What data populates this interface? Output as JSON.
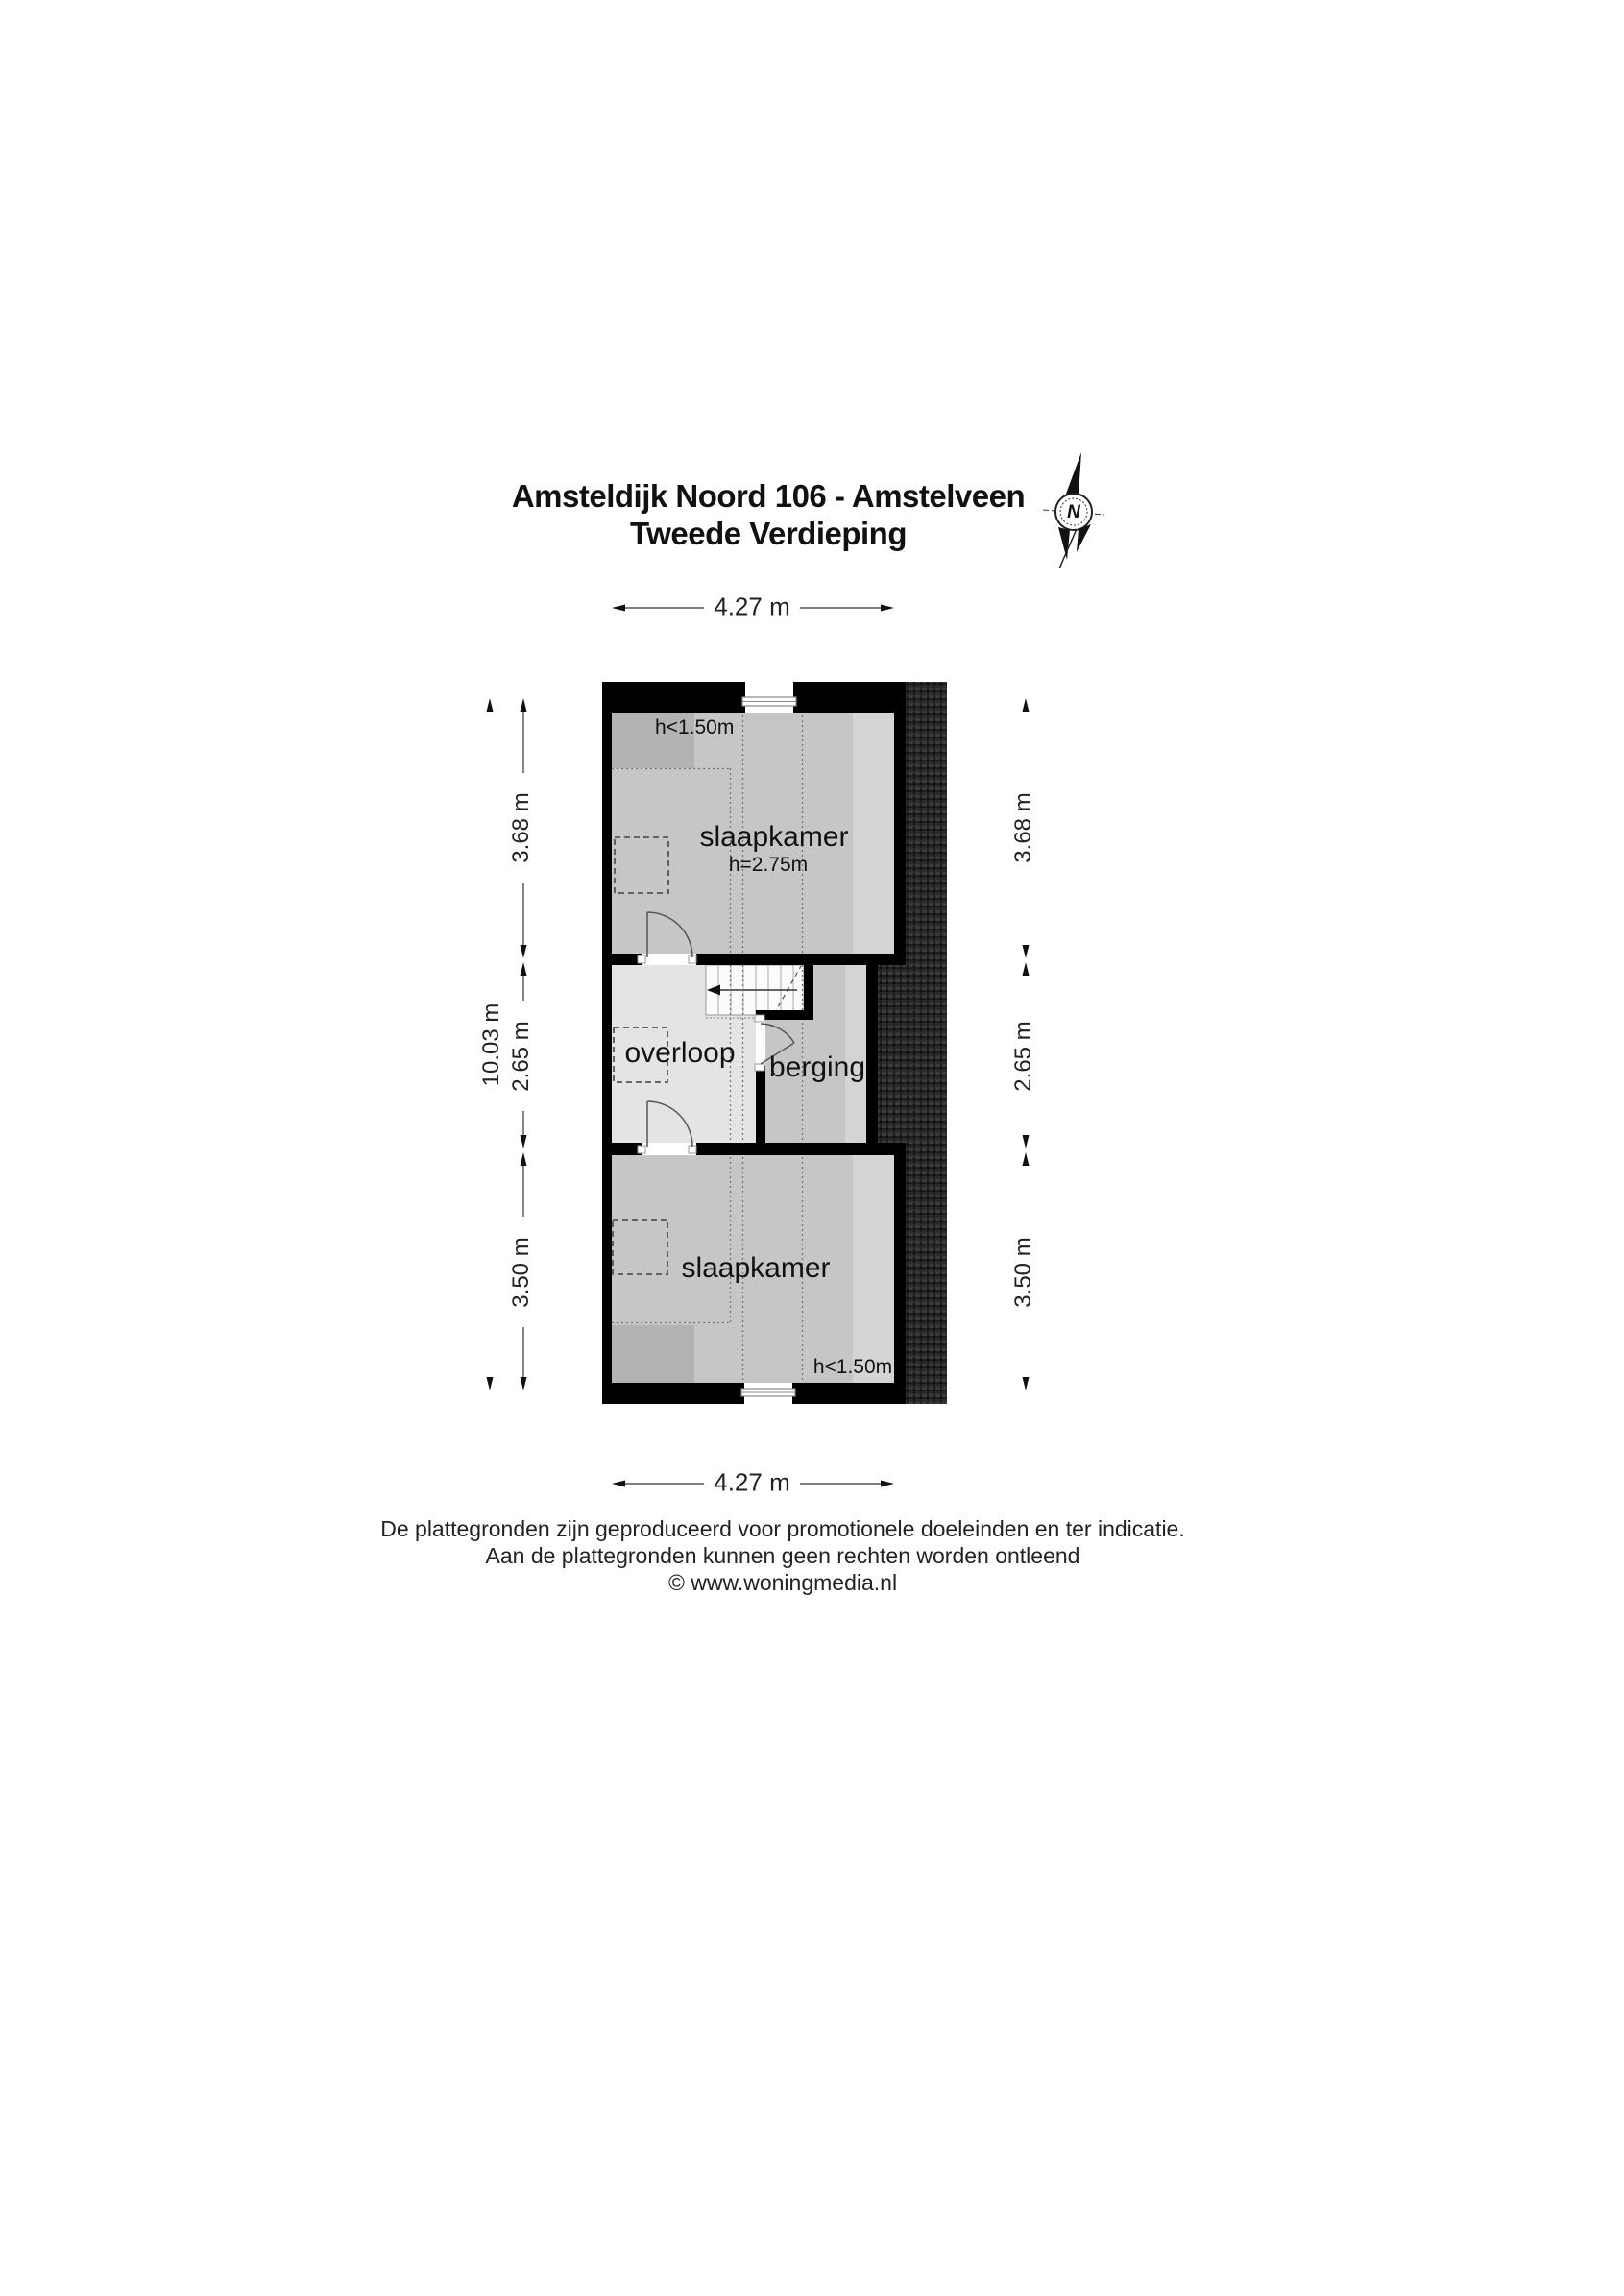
{
  "title": {
    "line1": "Amsteldijk Noord 106 - Amstelveen",
    "line2": "Tweede Verdieping"
  },
  "compass": {
    "label": "N"
  },
  "dimensions": {
    "top": "4.27 m",
    "bottom": "4.27 m",
    "left": {
      "total": "10.03 m",
      "segments": [
        "3.68 m",
        "2.65 m",
        "3.50 m"
      ]
    },
    "right": {
      "segments": [
        "3.68 m",
        "2.65 m",
        "3.50 m"
      ]
    }
  },
  "rooms": {
    "bedroom_top": {
      "name": "slaapkamer",
      "ceiling_note": "h<1.50m",
      "height_note": "h=2.75m"
    },
    "landing": {
      "name": "overloop"
    },
    "storage": {
      "name": "berging"
    },
    "bedroom_bottom": {
      "name": "slaapkamer",
      "ceiling_note": "h<1.50m"
    }
  },
  "footer": {
    "line1": "De plattegronden zijn geproduceerd voor promotionele doeleinden en ter indicatie.",
    "line2": "Aan de plattegronden kunnen geen rechten worden ontleend",
    "line3": "© www.woningmedia.nl"
  },
  "colors": {
    "wall": "#000000",
    "room_gray": "#c6c6c6",
    "low_ceiling_gray": "#b3b3b3",
    "light_band": "#d4d4d4",
    "landing_gray": "#e4e4e4",
    "stairs_white": "#fbfbfb",
    "roof_tiles_dark": "#1f1f1f",
    "dotted_line": "#777777"
  }
}
